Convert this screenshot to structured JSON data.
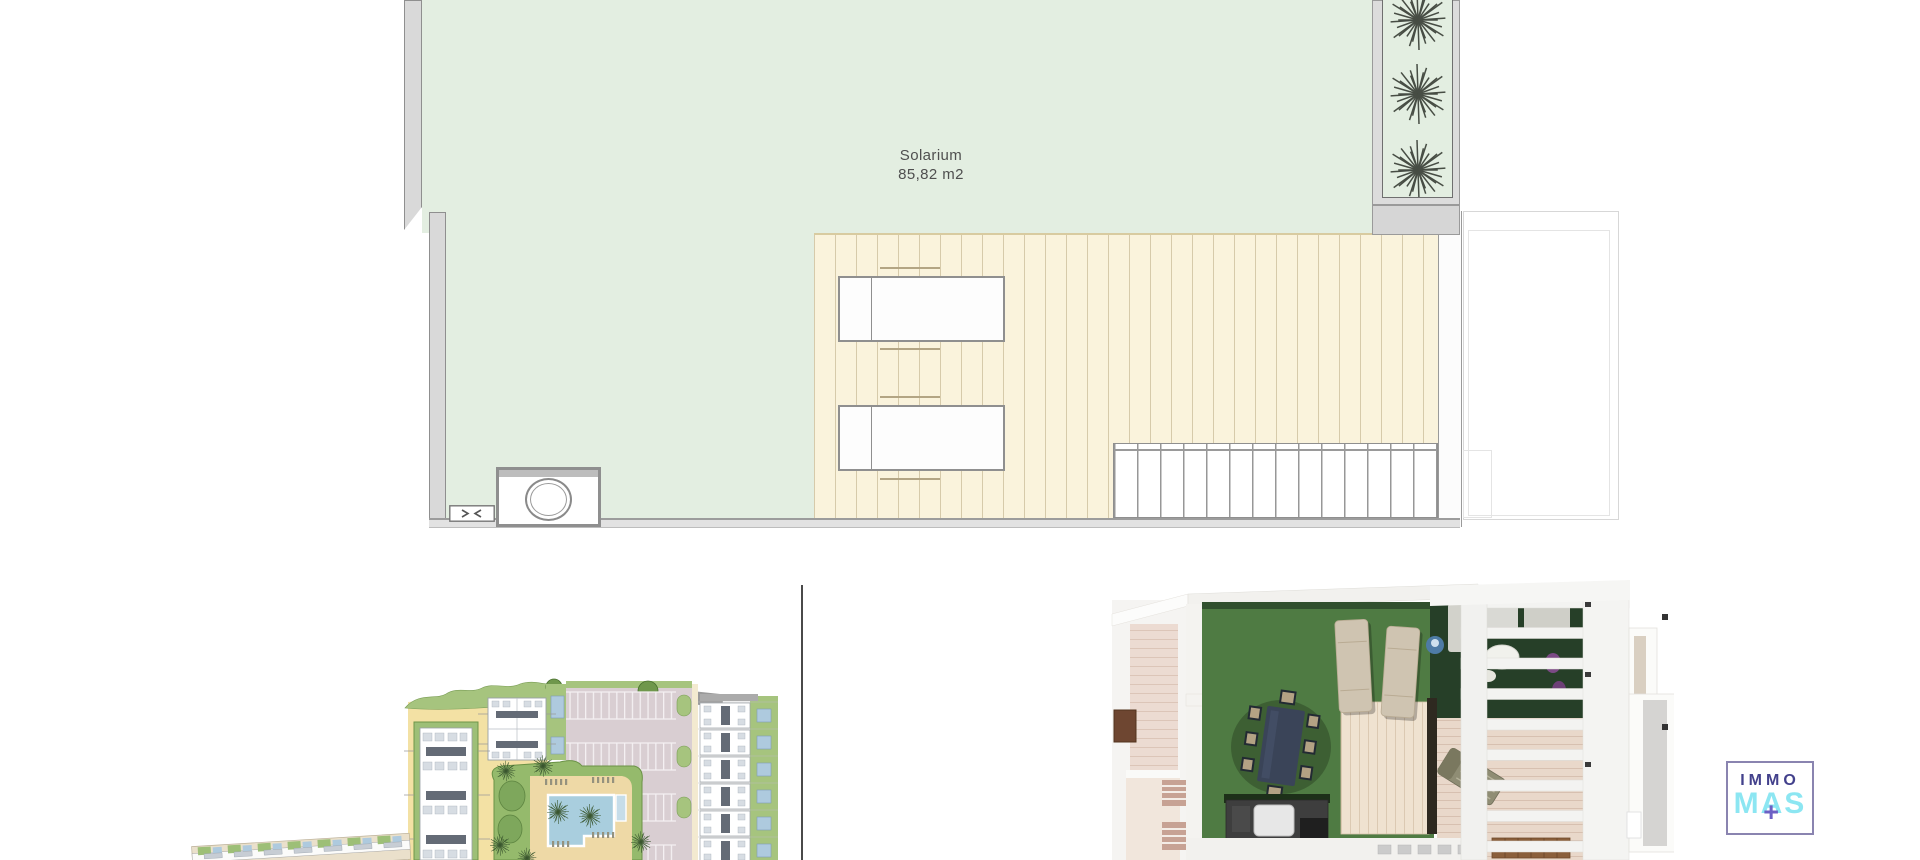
{
  "sheet": {
    "type": "architectural plan sheet",
    "background": "#ffffff"
  },
  "solarium_plan": {
    "room_label": "Solarium",
    "room_area": "85,82 m2",
    "colors": {
      "floor_green": "#e3eee1",
      "deck_cream": "#faf3dc",
      "wall_gray": "#d9d9d9",
      "plant": "#474d44",
      "label_text": "#4f4f4f"
    }
  },
  "site_plan": {
    "colors": {
      "path_yellow": "#f3e1a4",
      "garden_green": "#a6c47e",
      "parking_asphalt": "#d9ced2",
      "pool_blue": "#a9cede",
      "sand": "#eed9a6",
      "building_white": "#ffffff",
      "detail_blue": "#aecade"
    }
  },
  "render_3d": {
    "colors": {
      "lawn_green": "#4f7b43",
      "shade_green": "#263f28",
      "deck_wood": "#efe2d0",
      "terrace_pink": "#ecdbd2",
      "pergola_white": "#f3f3f1",
      "table_navy": "#3a4458",
      "steps_brown": "#8a5f3b",
      "door_brown": "#6e4631"
    }
  },
  "logo": {
    "top": "IMMO",
    "bottom": "MAS",
    "plus": "+",
    "colors": {
      "border": "#8a84b0",
      "top_text": "#43418c",
      "bottom_text": "#8ce6f2",
      "plus": "#6c60c4"
    }
  },
  "icons": {
    "plant-icon": "starburst plant, top view",
    "palm-tree-icon": "small starburst palm, site plan",
    "door-arrows-icon": "opposing arrows in small box",
    "jacuzzi-icon": "double ring circle in alcove",
    "plus-icon": "purple plus in logo"
  }
}
